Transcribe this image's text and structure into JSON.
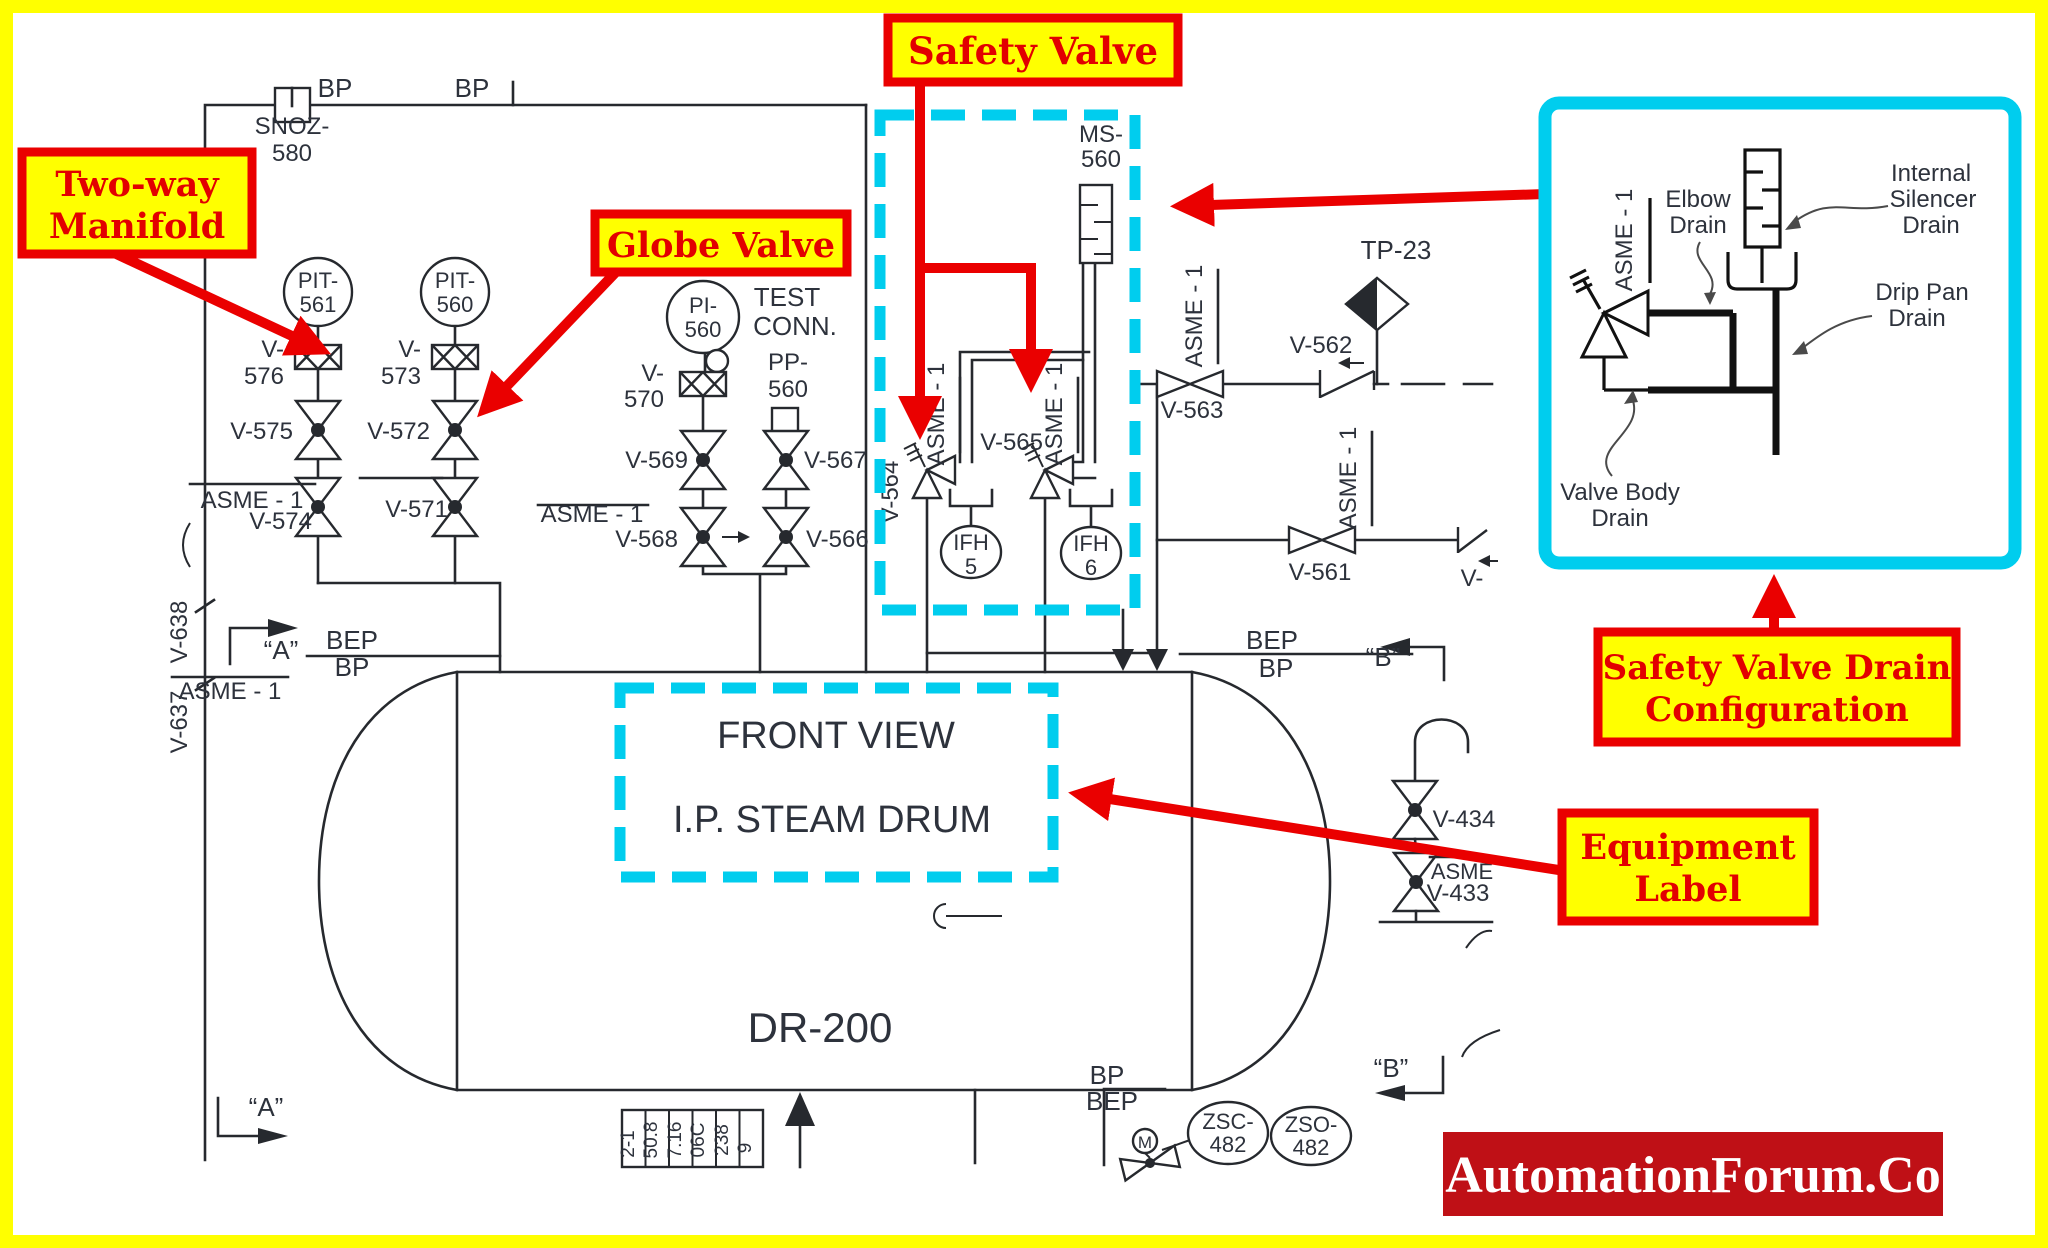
{
  "colors": {
    "frame": "#ffff00",
    "callout_fill": "#ffff00",
    "callout_border": "#ea0000",
    "callout_text": "#e20000",
    "highlight_cyan": "#00cdee",
    "line_black": "#26292e",
    "logo_bg": "#bf1016",
    "logo_text": "#ffffff"
  },
  "callouts": {
    "two_way_manifold": {
      "lines": [
        "Two-way",
        "Manifold"
      ]
    },
    "globe_valve": {
      "lines": [
        "Globe Valve"
      ]
    },
    "safety_valve": {
      "lines": [
        "Safety Valve"
      ]
    },
    "safety_valve_drain_configuration": {
      "lines": [
        "Safety Valve Drain",
        "Configuration"
      ]
    },
    "equipment_label": {
      "lines": [
        "Equipment",
        "Label"
      ]
    }
  },
  "inset": {
    "labels": {
      "elbow_drain": [
        "Elbow",
        "Drain"
      ],
      "internal_silencer_drain": [
        "Internal",
        "Silencer",
        "Drain"
      ],
      "drip_pan_drain": [
        "Drip Pan",
        "Drain"
      ],
      "valve_body_drain": [
        "Valve Body",
        "Drain"
      ]
    }
  },
  "pid": {
    "equipment": {
      "front_view": "FRONT VIEW",
      "name": "I.P. STEAM DRUM",
      "tag": "DR-200"
    },
    "instruments": {
      "pit561": [
        "PIT-",
        "561"
      ],
      "pit560": [
        "PIT-",
        "560"
      ],
      "pi560": [
        "PI-",
        "560"
      ],
      "ifh5": [
        "IFH",
        "5"
      ],
      "ifh6": [
        "IFH",
        "6"
      ],
      "zsc482": [
        "ZSC-",
        "482"
      ],
      "zso482": [
        "ZSO-",
        "482"
      ],
      "motor": "M"
    },
    "valves": {
      "v576": [
        "V-",
        "576"
      ],
      "v573": [
        "V-",
        "573"
      ],
      "v575": "V-575",
      "v572": "V-572",
      "v574": "V-574",
      "v571": "V-571",
      "v570": [
        "V-",
        "570"
      ],
      "v569": "V-569",
      "v568": "V-568",
      "v567": "V-567",
      "v566": "V-566",
      "v565": "V-565",
      "v564": "V-564",
      "v563": "V-563",
      "v562": "V-562",
      "v561": "V-561",
      "v434": "V-434",
      "v433": "V-433",
      "v_partial": "V-",
      "v638": "V-638",
      "v637": "V-637"
    },
    "tags": {
      "snoz": [
        "SNOZ-",
        "580"
      ],
      "ms560": [
        "MS-",
        "560"
      ],
      "pp560": [
        "PP-",
        "560"
      ],
      "test_conn": [
        "TEST",
        "CONN."
      ],
      "tp23": "TP-23"
    },
    "class_labels": {
      "asme": "ASME - 1",
      "asme_partial": "ASME"
    },
    "flow_labels": {
      "bp": "BP",
      "bep": "BEP"
    },
    "markers": {
      "a": "“A”",
      "b": "“B”"
    },
    "table": [
      "2-1",
      "50.8",
      "7.16",
      "06C",
      "238",
      "9"
    ]
  },
  "logo": {
    "text": "AutomationForum.Co"
  }
}
